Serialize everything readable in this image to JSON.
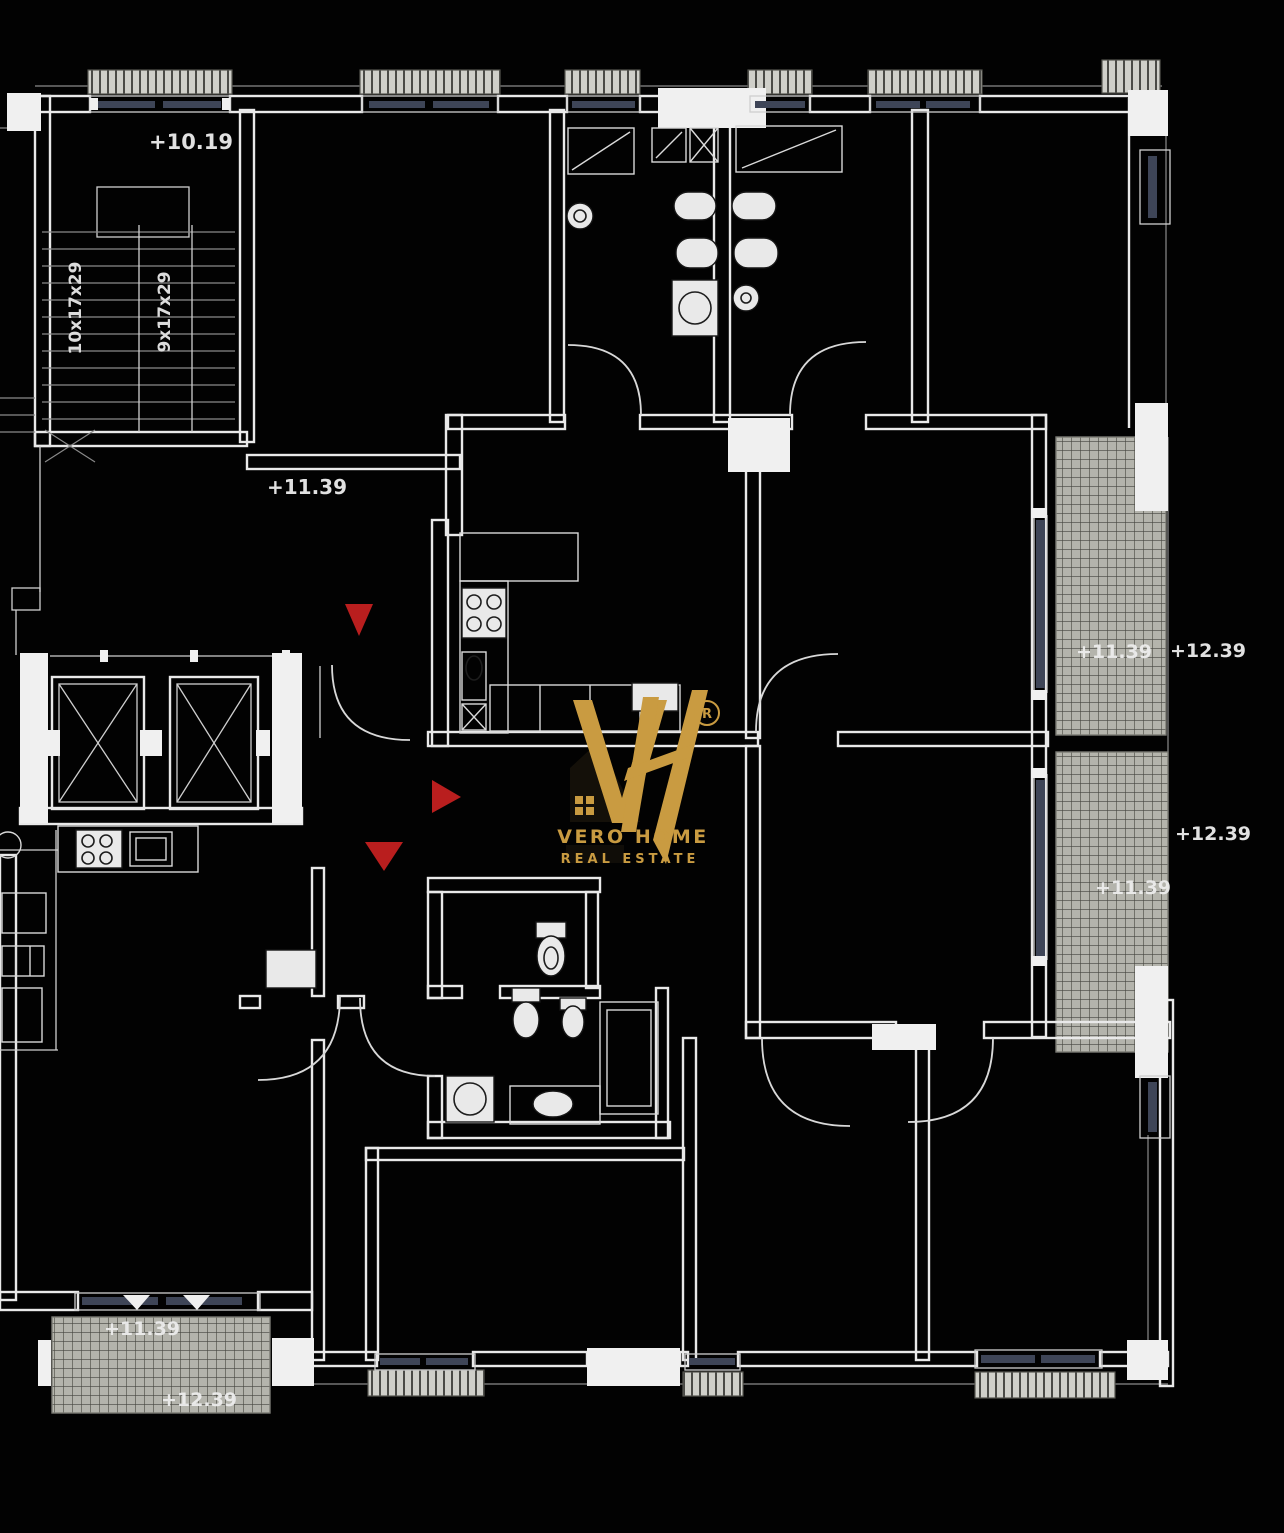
{
  "drawing": {
    "type": "architectural-floor-plan",
    "style": "cad-black-background"
  },
  "colors": {
    "background": "#020202",
    "wall": "#e9e9e9",
    "wall_dim": "#9a9a9a",
    "glazing": "#3e4557",
    "hatch_bg": "#b4b4ac",
    "hatch_line": "#45453f",
    "radiator_bg": "#cfcfc9",
    "radiator_line": "#4a4a46",
    "red": "#c32020",
    "gold": "#c99b41",
    "text": "#ededed"
  },
  "elevation_labels": [
    {
      "text": "+10.19",
      "x": 191,
      "y": 149,
      "size": 21
    },
    {
      "text": "+11.39",
      "x": 307,
      "y": 494,
      "size": 20
    },
    {
      "text": "+11.39",
      "x": 1114,
      "y": 658,
      "size": 19
    },
    {
      "text": "+12.39",
      "x": 1208,
      "y": 657,
      "size": 19
    },
    {
      "text": "+12.39",
      "x": 1213,
      "y": 840,
      "size": 19
    },
    {
      "text": "+11.39",
      "x": 1133,
      "y": 894,
      "size": 19
    },
    {
      "text": "+11.39",
      "x": 142,
      "y": 1335,
      "size": 19
    },
    {
      "text": "+12.39",
      "x": 199,
      "y": 1406,
      "size": 19
    }
  ],
  "stair_labels": [
    {
      "text": "10x17x29",
      "x": 81,
      "y": 308,
      "size": 17
    },
    {
      "text": "9x17x29",
      "x": 170,
      "y": 312,
      "size": 17
    }
  ],
  "markers": [
    {
      "shape": "triangle-down",
      "points": "345,604 373,604 359,636"
    },
    {
      "shape": "triangle-right",
      "points": "432,780 432,813 461,797"
    },
    {
      "shape": "triangle-down",
      "points": "365,842 403,842 384,871"
    }
  ],
  "logo": {
    "monogram": "VH",
    "registered": "R",
    "name": "VERO HOME",
    "tagline": "REAL ESTATE"
  }
}
